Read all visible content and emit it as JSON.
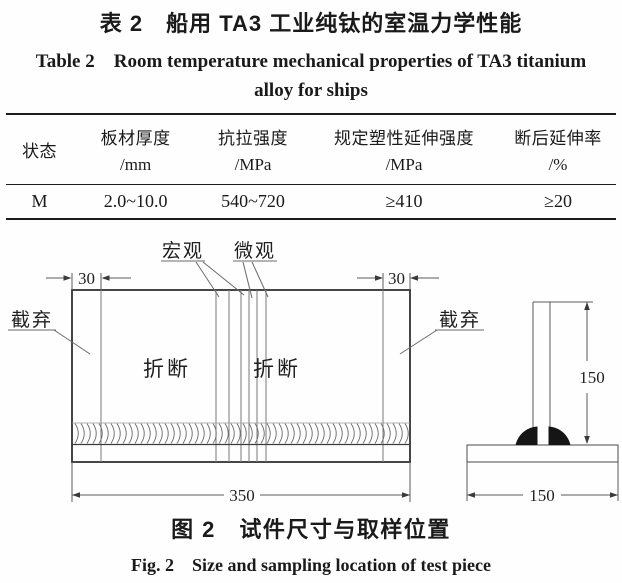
{
  "table_caption": {
    "zh": "表 2　船用 TA3 工业纯钛的室温力学性能",
    "en_line1": "Table 2　Room temperature mechanical properties of TA3 titanium",
    "en_line2": "alloy for ships"
  },
  "table": {
    "columns": [
      {
        "label": "状态",
        "unit": ""
      },
      {
        "label": "板材厚度",
        "unit": "/mm"
      },
      {
        "label": "抗拉强度",
        "unit": "/MPa"
      },
      {
        "label": "规定塑性延伸强度",
        "unit": "/MPa"
      },
      {
        "label": "断后延伸率",
        "unit": "/%"
      }
    ],
    "rows": [
      [
        "M",
        "2.0~10.0",
        "540~720",
        "≥410",
        "≥20"
      ]
    ]
  },
  "figure": {
    "labels": {
      "macro": "宏观",
      "micro": "微观",
      "discard_left": "截弃",
      "discard_right": "截弃",
      "break_left": "折断",
      "break_right": "折断"
    },
    "dimensions": {
      "left_margin": "30",
      "right_margin": "30",
      "total_length": "350",
      "web_height": "150",
      "flange_width": "150"
    }
  },
  "figure_caption": {
    "zh": "图 2　试件尺寸与取样位置",
    "en": "Fig. 2　Size and sampling location of test piece"
  }
}
